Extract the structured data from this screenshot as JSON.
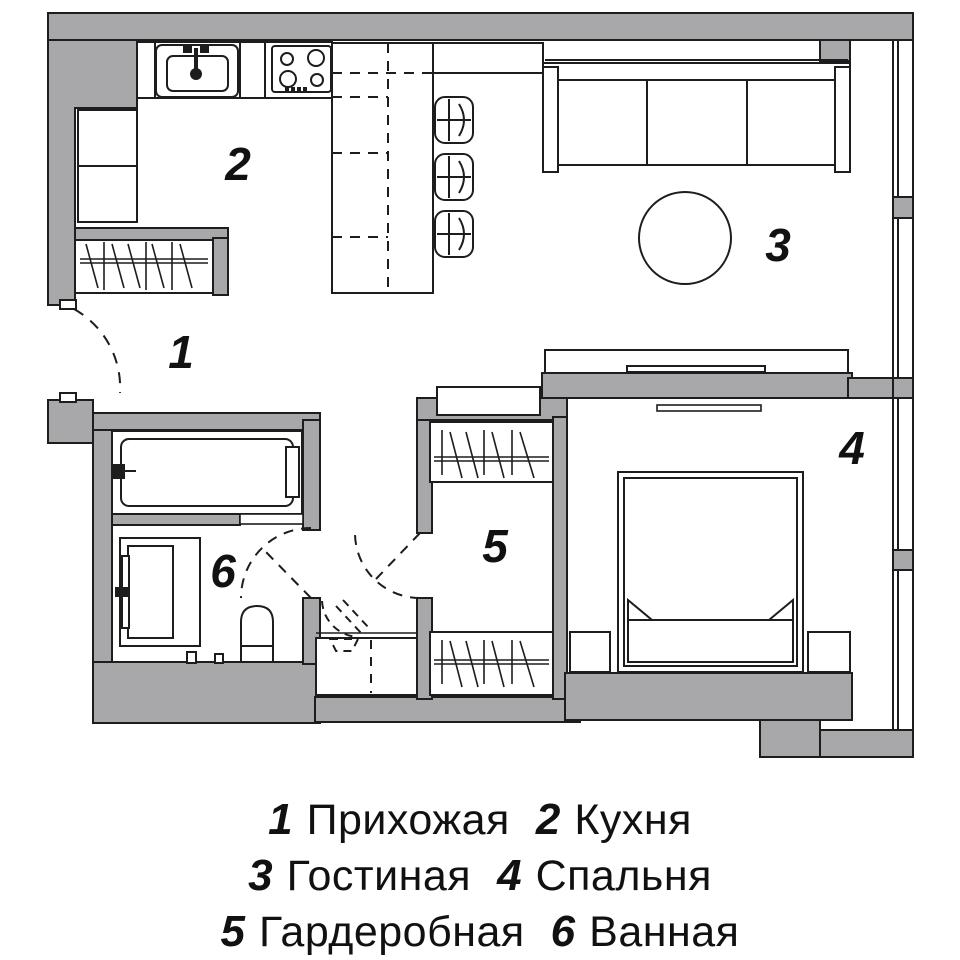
{
  "colors": {
    "wall": "#a8a8aa",
    "line": "#1d1d1d",
    "background": "#ffffff"
  },
  "rooms": [
    {
      "number": "1",
      "name": "Прихожая"
    },
    {
      "number": "2",
      "name": "Кухня"
    },
    {
      "number": "3",
      "name": "Гостиная"
    },
    {
      "number": "4",
      "name": "Спальня"
    },
    {
      "number": "5",
      "name": "Гардеробная"
    },
    {
      "number": "6",
      "name": "Ванная"
    }
  ],
  "fixtures": [
    "kitchen-sink",
    "stove-4-burners",
    "kitchen-cabinets",
    "hall-closet-rail",
    "kitchen-island",
    "bar-counter",
    "bar-stools-x3",
    "sofa-3-seat",
    "round-table",
    "tv-console",
    "wall-tv",
    "double-bed",
    "nightstands",
    "wardrobe-rails",
    "utility-closet",
    "bathtub",
    "shower",
    "toilet",
    "entrance-door",
    "interior-doors",
    "windows"
  ]
}
